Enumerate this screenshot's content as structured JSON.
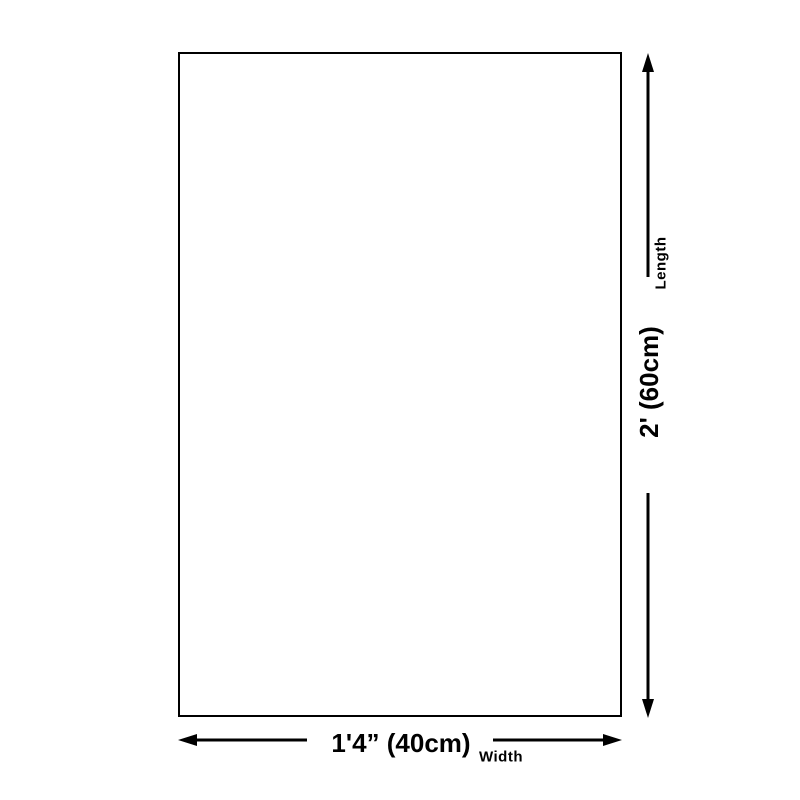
{
  "page": {
    "background_color": "#ffffff",
    "line_color": "#000000",
    "text_color": "#000000"
  },
  "diagram": {
    "length": {
      "axis_label": "Length",
      "value": "2' (60cm)"
    },
    "width": {
      "axis_label": "Width",
      "value": "1'4” (40cm)"
    }
  }
}
